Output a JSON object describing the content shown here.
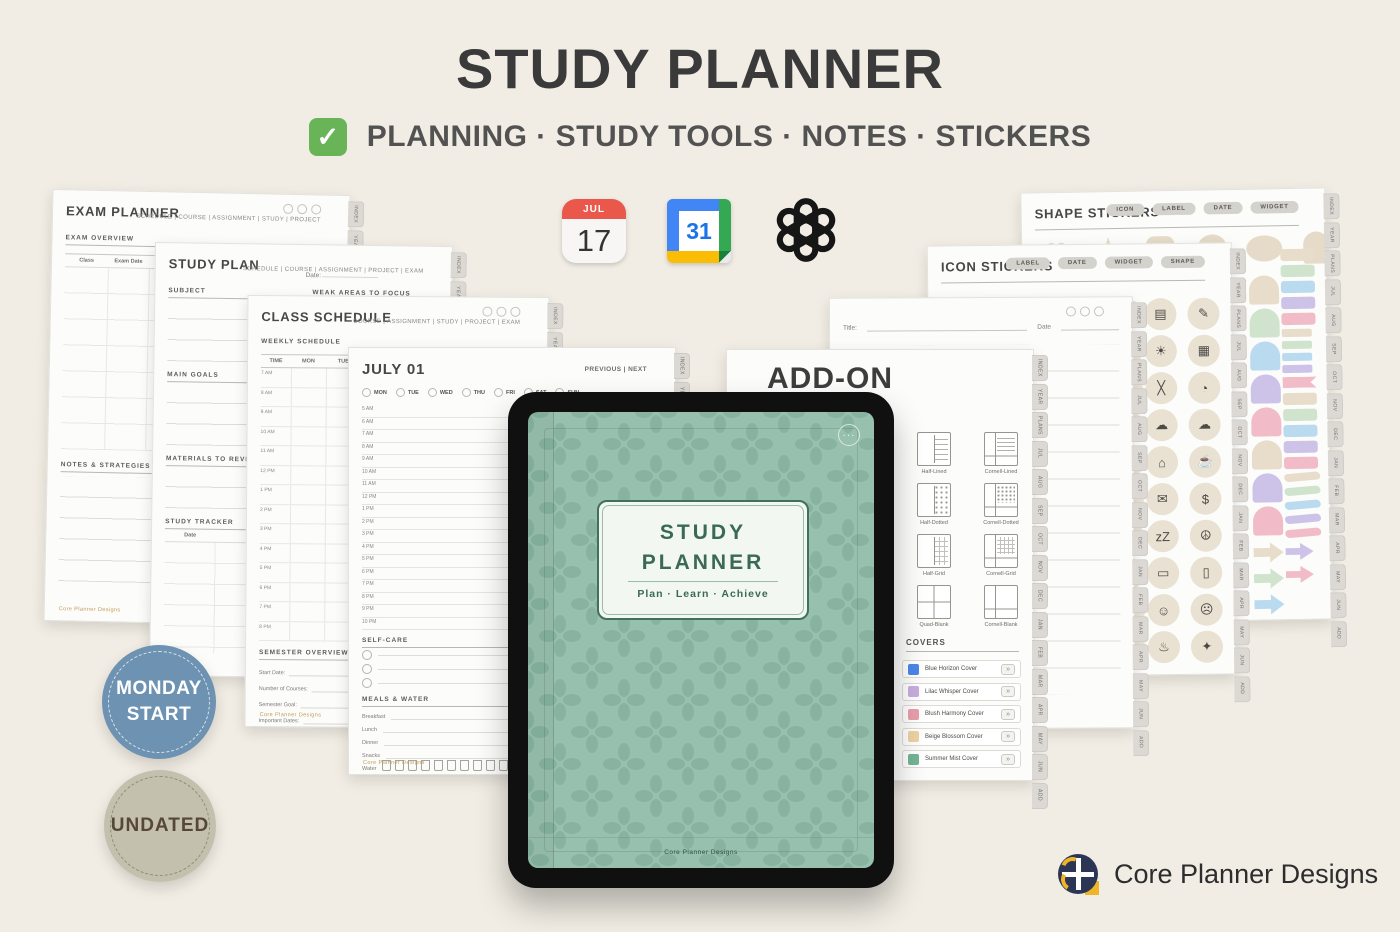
{
  "header": {
    "title": "STUDY PLANNER",
    "tagline": "PLANNING · STUDY TOOLS · NOTES · STICKERS",
    "check_glyph": "✓"
  },
  "app_icons": {
    "apple_calendar": {
      "month": "JUL",
      "day": "17"
    },
    "google_calendar": {
      "day": "31"
    },
    "openai": {
      "name": "openai-logo"
    }
  },
  "badges": {
    "monday_start": {
      "line1": "MONDAY",
      "line2": "START"
    },
    "undated": {
      "label": "UNDATED"
    }
  },
  "brand": {
    "name": "Core Planner Designs"
  },
  "tablet": {
    "cover_title_line1": "STUDY",
    "cover_title_line2": "PLANNER",
    "cover_tagline": "Plan · Learn · Achieve",
    "dots": "···",
    "footer": "Core Planner Designs"
  },
  "side_tabs": [
    "INDEX",
    "YEAR",
    "PLANS",
    "JUL",
    "AUG",
    "SEP",
    "OCT",
    "NOV",
    "DEC",
    "JAN",
    "FEB",
    "MAR",
    "APR",
    "MAY",
    "JUN",
    "ADD"
  ],
  "pages": {
    "exam_planner": {
      "title": "EXAM PLANNER",
      "nav": "SCHEDULE | COURSE | ASSIGNMENT | STUDY | PROJECT",
      "overview_label": "EXAM OVERVIEW",
      "columns": [
        "Class",
        "Exam Date",
        "Review Topics",
        "Materials",
        "Progress (%)"
      ],
      "notes_label": "NOTES & STRATEGIES",
      "footer": "Core Planner Designs"
    },
    "study_plan": {
      "title": "STUDY PLAN",
      "date_label": "Date:",
      "nav": "SCHEDULE | COURSE | ASSIGNMENT | PROJECT | EXAM",
      "subject_label": "SUBJECT",
      "weak_areas_label": "WEAK AREAS TO FOCUS",
      "main_goals_label": "MAIN GOALS",
      "materials_label": "MATERIALS TO REVIEW",
      "tracker_label": "STUDY TRACKER",
      "tracker_col": "Date"
    },
    "class_schedule": {
      "title": "CLASS SCHEDULE",
      "nav": "COURSE | ASSIGNMENT | STUDY | PROJECT | EXAM",
      "weekly_label": "WEEKLY SCHEDULE",
      "columns": [
        "TIME",
        "MON",
        "TUE",
        "WED",
        "THU",
        "FRI",
        "SAT",
        "SUN"
      ],
      "times": [
        "7 AM",
        "8 AM",
        "9 AM",
        "10 AM",
        "11 AM",
        "12 PM",
        "1 PM",
        "2 PM",
        "3 PM",
        "4 PM",
        "5 PM",
        "6 PM",
        "7 PM",
        "8 PM"
      ],
      "semester_label": "SEMESTER OVERVIEW",
      "semester_fields": [
        "Start Date:",
        "End Date:",
        "Number of Courses:",
        "Total Credits:",
        "Semester Goal:",
        "Important Dates:"
      ],
      "footer": "Core Planner Designs"
    },
    "daily": {
      "title": "JULY 01",
      "nav": "PREVIOUS | NEXT",
      "days": [
        "MON",
        "TUE",
        "WED",
        "THU",
        "FRI",
        "SAT",
        "SUN"
      ],
      "times": [
        "5 AM",
        "6 AM",
        "7 AM",
        "8 AM",
        "9 AM",
        "10 AM",
        "11 AM",
        "12 PM",
        "1 PM",
        "2 PM",
        "3 PM",
        "4 PM",
        "5 PM",
        "6 PM",
        "7 PM",
        "8 PM",
        "9 PM",
        "10 PM"
      ],
      "self_care_label": "SELF-CARE",
      "self_care_rows": [
        "",
        "",
        ""
      ],
      "meals_label": "MEALS & WATER",
      "meals": [
        "Breakfast",
        "Lunch",
        "Dinner",
        "Snacks"
      ],
      "water_label": "Water",
      "water_cups": [
        "",
        "",
        "",
        "",
        "",
        "",
        "",
        "",
        "",
        "",
        ""
      ],
      "footer": "Core Planner Designs"
    },
    "notes": {
      "title_label": "Title:",
      "date_label": "Date"
    },
    "add_on": {
      "title": "ADD-ON",
      "subtitle": "Pages for Students",
      "template_rows": [
        {
          "a": {
            "name": "Half-Lined",
            "kind": "half-lined"
          },
          "b": {
            "name": "Cornell-Lined",
            "kind": "cornell-lined"
          }
        },
        {
          "a": {
            "name": "Half-Dotted",
            "kind": "half-dotted"
          },
          "b": {
            "name": "Cornell-Dotted",
            "kind": "cornell-dotted"
          }
        },
        {
          "a": {
            "name": "Half-Grid",
            "kind": "half-grid"
          },
          "b": {
            "name": "Cornell-Grid",
            "kind": "cornell-grid"
          }
        },
        {
          "a": {
            "name": "Quad-Blank",
            "kind": "quad-blank"
          },
          "b": {
            "name": "Cornell-Blank",
            "kind": "cornell-blank"
          }
        }
      ],
      "covers_label": "COVERS",
      "covers": [
        {
          "name": "Blue Horizon Cover",
          "color": "#4b86e8"
        },
        {
          "name": "Lilac Whisper Cover",
          "color": "#c7aede"
        },
        {
          "name": "Blush Harmony Cover",
          "color": "#e89fab"
        },
        {
          "name": "Beige Blossom Cover",
          "color": "#edd2a2"
        },
        {
          "name": "Summer Mist Cover",
          "color": "#74b495"
        }
      ],
      "cover_button": "»"
    },
    "icon_stickers": {
      "title": "ICON STICKERS",
      "pills": [
        "LABEL",
        "DATE",
        "WIDGET",
        "SHAPE"
      ],
      "icons": [
        {
          "name": "notebook-icon",
          "glyph": "▤"
        },
        {
          "name": "pencil-icon",
          "glyph": "✎"
        },
        {
          "name": "lightbulb-icon",
          "glyph": "☀"
        },
        {
          "name": "calendar-icon",
          "glyph": "▦"
        },
        {
          "name": "crossed-pencils-icon",
          "glyph": "╳"
        },
        {
          "name": "clock-icon",
          "glyph": "◔"
        },
        {
          "name": "cloud-download-icon",
          "glyph": "☁"
        },
        {
          "name": "cloud-upload-icon",
          "glyph": "☁"
        },
        {
          "name": "home-icon",
          "glyph": "⌂"
        },
        {
          "name": "coffee-icon",
          "glyph": "☕"
        },
        {
          "name": "mail-icon",
          "glyph": "✉"
        },
        {
          "name": "coin-icon",
          "glyph": "$"
        },
        {
          "name": "sleep-icon",
          "glyph": "zZ"
        },
        {
          "name": "meditation-icon",
          "glyph": "☮"
        },
        {
          "name": "car-icon",
          "glyph": "▭"
        },
        {
          "name": "bus-icon",
          "glyph": "▯"
        },
        {
          "name": "happy-face-icon",
          "glyph": "☺"
        },
        {
          "name": "neutral-face-icon",
          "glyph": "☹"
        },
        {
          "name": "flask-icon",
          "glyph": "♨"
        },
        {
          "name": "sparkles-icon",
          "glyph": "✦"
        }
      ]
    },
    "shape_stickers": {
      "title": "SHAPE STICKERS",
      "pills": [
        "ICON",
        "LABEL",
        "DATE",
        "WIDGET"
      ],
      "top_shapes": [
        {
          "kind": "heart",
          "glyph": "♥"
        },
        {
          "kind": "star",
          "glyph": "★"
        },
        {
          "kind": "squircle",
          "glyph": ""
        },
        {
          "kind": "circle",
          "glyph": ""
        },
        {
          "kind": "blob",
          "glyph": ""
        },
        {
          "kind": "arch",
          "glyph": ""
        }
      ],
      "tab_column": [
        "#e7ddca",
        "#cfe3cd",
        "#badaf0",
        "#cdc2e8",
        "#f1bcc8",
        "#e7ddca",
        "#cdc2e8",
        "#f1bcc8"
      ],
      "tab_arrows": [
        "#e7ddca",
        "#cfe3cd",
        "#badaf0"
      ],
      "rect_column": [
        "#e7ddca",
        "#cfe3cd",
        "#badaf0",
        "#cdc2e8",
        "#f1bcc8"
      ],
      "rect_small_column": [
        "#e7ddca",
        "#cfe3cd",
        "#badaf0",
        "#cdc2e8"
      ],
      "flag_color": "#f1bcc8",
      "rect_column2": [
        "#e7ddca",
        "#cfe3cd",
        "#badaf0",
        "#cdc2e8",
        "#f1bcc8"
      ],
      "ribbon_column": [
        "#e7ddca",
        "#cfe3cd",
        "#badaf0",
        "#cdc2e8",
        "#f1bcc8"
      ],
      "arrow_column": [
        "#cdc2e8",
        "#f1bcc8"
      ]
    }
  }
}
